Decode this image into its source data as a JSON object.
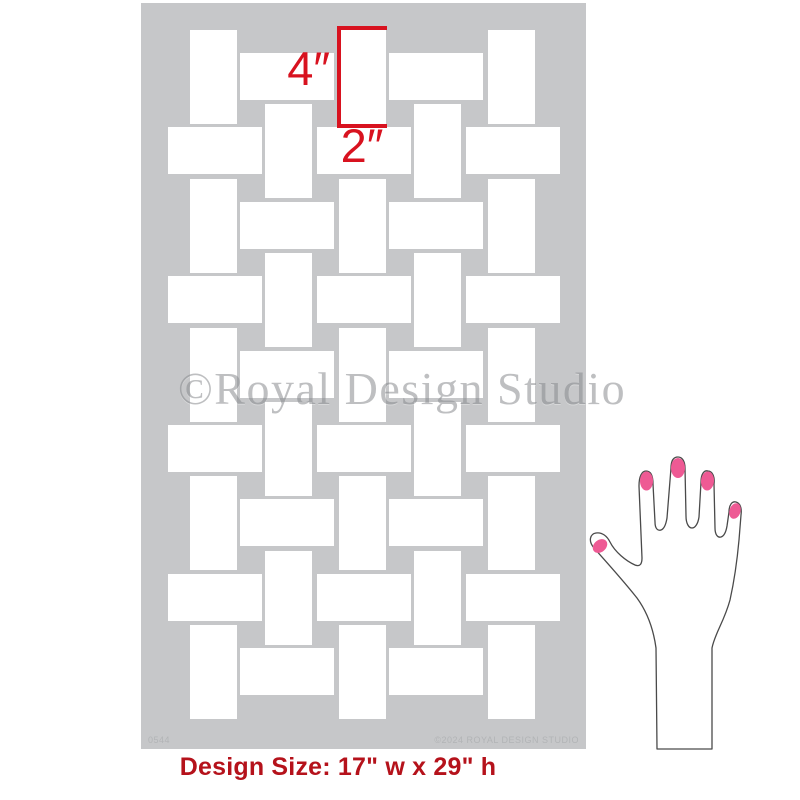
{
  "product_image": {
    "description": "Basket weave stencil sheet with dimension annotations and hand for scale"
  },
  "stencil": {
    "sheet_color": "#c6c7c9",
    "brick_color": "#ffffff",
    "watermark": "©Royal Design Studio",
    "watermark_color": "#8a8c8f",
    "code": "0544",
    "copyright": "©2024 ROYAL DESIGN STUDIO",
    "microtext_color": "#b2b4b6"
  },
  "annotations": {
    "height_label": "4″",
    "width_label": "2″",
    "accent_color": "#d8121f"
  },
  "design_size": {
    "label": "Design Size: 17\" w x 29\" h",
    "color": "#b5121b"
  },
  "hand": {
    "nail_color": "#ee5a94",
    "outline_color": "#4a4a4a"
  },
  "pattern": {
    "brick": {
      "v_w": 47,
      "v_h": 94,
      "h_w": 94,
      "h_h": 47
    },
    "h_offset_y": 23,
    "row_type_a": {
      "v_x": [
        49,
        198,
        347
      ],
      "h_x": [
        99,
        248
      ],
      "tops": [
        27,
        176,
        325,
        473,
        622
      ]
    },
    "row_type_b": {
      "v_x": [
        124,
        273
      ],
      "h_x": [
        27,
        176,
        325
      ],
      "tops": [
        101,
        250,
        399,
        548
      ]
    }
  }
}
